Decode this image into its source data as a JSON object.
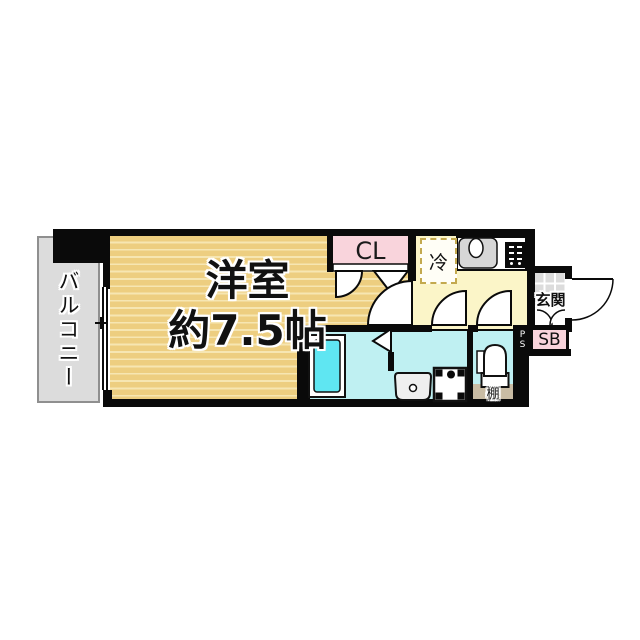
{
  "floor_plan": {
    "balcony": {
      "label": "バルコニー"
    },
    "main_room": {
      "name_line": "洋室",
      "size_line": "約7.5帖"
    },
    "closet": {
      "label": "CL"
    },
    "fridge": {
      "label": "冷"
    },
    "entrance": {
      "label": "玄関"
    },
    "shoe_box": {
      "label": "SB"
    },
    "pipe_space": {
      "letters": [
        "P",
        "S"
      ]
    },
    "shelf": {
      "label": "棚"
    }
  },
  "colors": {
    "wall": "#0a0a0a",
    "room_floor": "#EDCE80",
    "room_stripe": "#F6E6B2",
    "balcony": "#DCDCDC",
    "balcony_border": "#8F8F8F",
    "closet": "#F9D4DC",
    "kitchen": "#FBF5C8",
    "wet_area": "#BFF0F2",
    "bathtub": "#5FE6F2",
    "shelf": "#C9BCA4",
    "tile": "#DCDCDC",
    "fridge_dash": "#C3A94E",
    "sink": "#D6D6D6"
  }
}
